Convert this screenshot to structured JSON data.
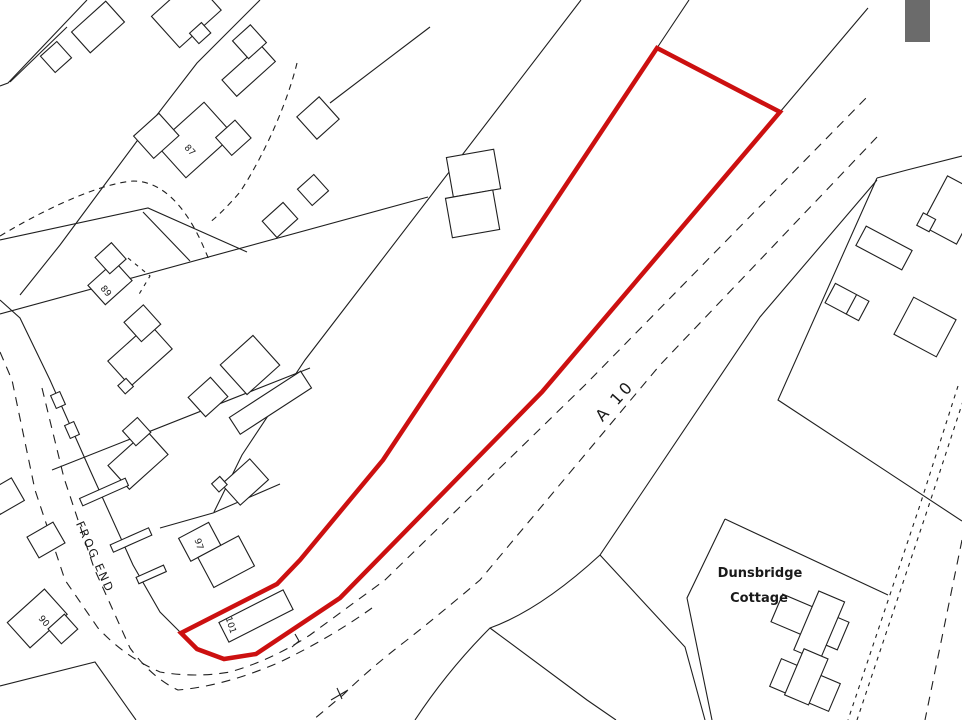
{
  "map": {
    "labels": {
      "a10": "A 10",
      "frog_end": "FROG END",
      "dunsbridge_line1": "Dunsbridge",
      "dunsbridge_line2": "Cottage",
      "house_87": "87",
      "house_89": "89",
      "house_97": "97",
      "house_101": "101",
      "house_90": "90"
    },
    "colors": {
      "site_boundary_red": "#cc1010",
      "linework_black": "#1f1f1f",
      "corner_mark_gray": "#6b6b6b",
      "background": "#ffffff"
    }
  }
}
